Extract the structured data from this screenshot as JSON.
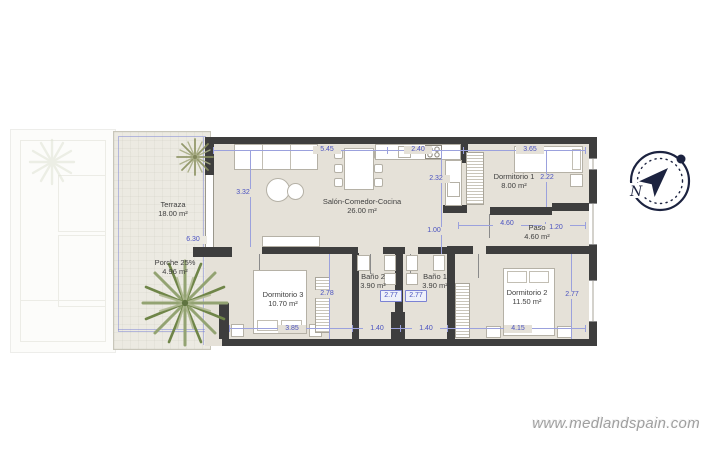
{
  "watermark": {
    "text": "www.medlandspain.com"
  },
  "compass": {
    "north_label": "N"
  },
  "plan": {
    "rooms": [
      {
        "name": "Terraza",
        "area": "18.00 m²"
      },
      {
        "name": "Porche 25%",
        "area": "4.96 m²"
      },
      {
        "name": "Salón-Comedor-Cocina",
        "area": "26.00 m²"
      },
      {
        "name": "Dormitorio 1",
        "area": "8.00 m²"
      },
      {
        "name": "Paso",
        "area": "4.60 m²"
      },
      {
        "name": "Dormitorio 3",
        "area": "10.70 m²"
      },
      {
        "name": "Baño 2",
        "area": "3.90 m²"
      },
      {
        "name": "Baño 1",
        "area": "3.90 m²"
      },
      {
        "name": "Dormitorio 2",
        "area": "11.50 m²"
      }
    ],
    "dimensions": [
      {
        "value": "5.45"
      },
      {
        "value": "2.40"
      },
      {
        "value": "3.65"
      },
      {
        "value": "3.32"
      },
      {
        "value": "2.32"
      },
      {
        "value": "2.22"
      },
      {
        "value": "1.00"
      },
      {
        "value": "4.60"
      },
      {
        "value": "1.20"
      },
      {
        "value": "6.30"
      },
      {
        "value": "2.78"
      },
      {
        "value": "2.77"
      },
      {
        "value": "2.77"
      },
      {
        "value": "2.77"
      },
      {
        "value": "3.85"
      },
      {
        "value": "1.40"
      },
      {
        "value": "1.40"
      },
      {
        "value": "4.15"
      }
    ],
    "colors": {
      "wall": "#3e3e3e",
      "floor": "#e5e1d8",
      "terrace": "#eceae2",
      "dimension": "#4a52c0",
      "compass": "#1c2340",
      "palm": "#7d9158"
    }
  }
}
